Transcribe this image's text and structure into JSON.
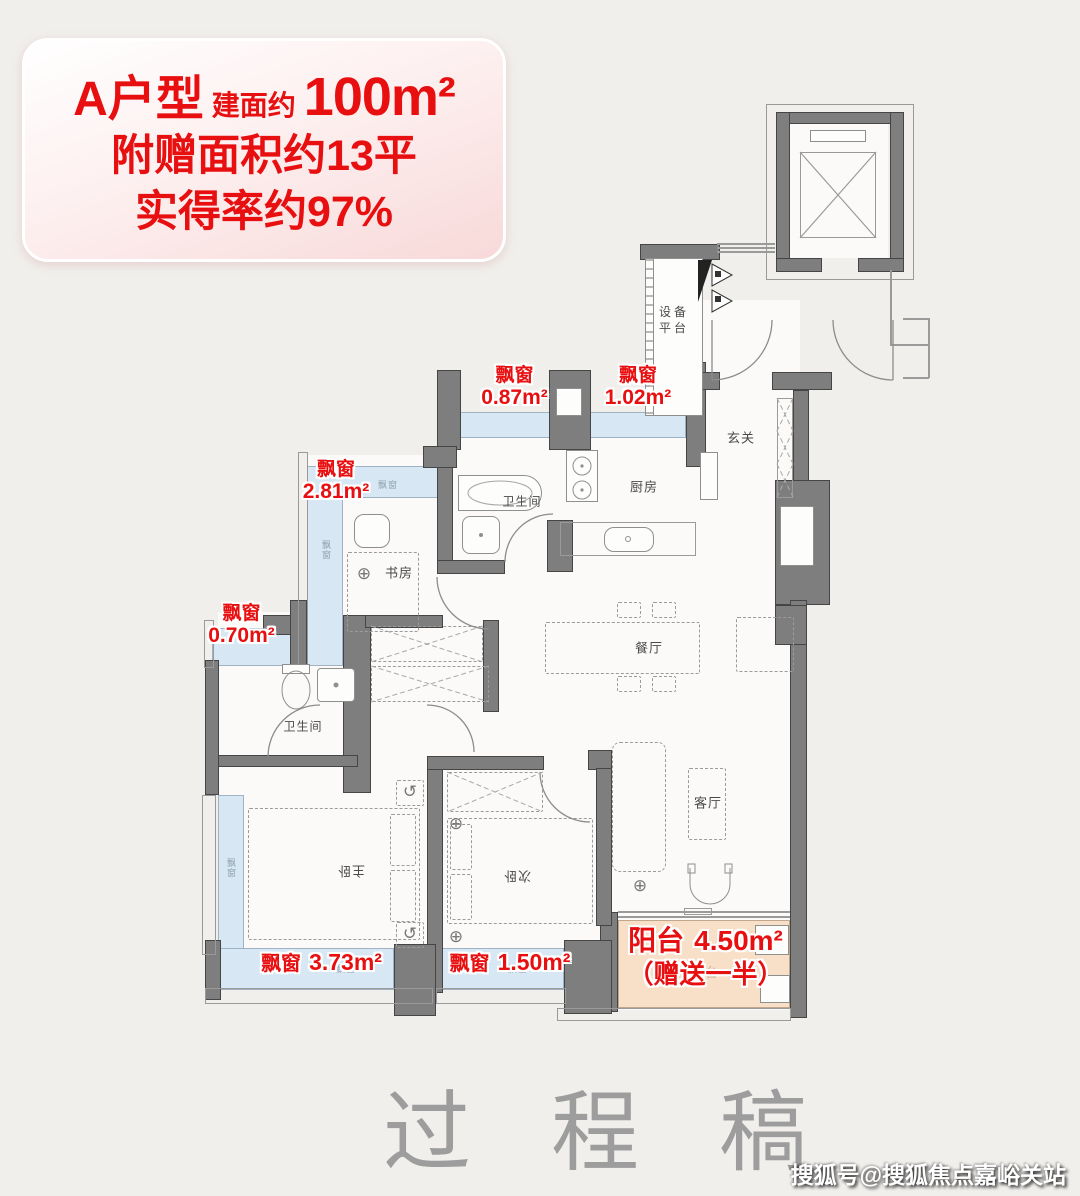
{
  "info_box": {
    "type_label": "A户型",
    "area_prefix": "建面约",
    "area_value": "100m²",
    "bonus_line": "附赠面积约13平",
    "rate_line": "实得率约97%"
  },
  "rooms": {
    "equipment_platform": "设备平台",
    "entry": "玄关",
    "kitchen": "厨房",
    "bathroom_upper": "卫生间",
    "study": "书房",
    "bathroom_lower": "卫生间",
    "dining": "餐厅",
    "living": "客厅",
    "master_bedroom": "主卧",
    "second_bedroom": "次卧"
  },
  "bay_tag": "飘窗",
  "bay_labels": {
    "b087": {
      "name": "飘窗",
      "area": "0.87m²"
    },
    "b102": {
      "name": "飘窗",
      "area": "1.02m²"
    },
    "b281": {
      "name": "飘窗",
      "area": "2.81m²"
    },
    "b070": {
      "name": "飘窗",
      "area": "0.70m²"
    },
    "b373": {
      "name": "飘窗",
      "area": "3.73m²"
    },
    "b150": {
      "name": "飘窗",
      "area": "1.50m²"
    }
  },
  "balcony_label": {
    "name": "阳台",
    "area": "4.50m²",
    "note": "（赠送一半）",
    "bg_text": "阳台"
  },
  "watermark": "过程稿",
  "credit": "搜狐号@搜狐焦点嘉峪关站",
  "icons": {
    "compass": "⊕",
    "rotate": "↺"
  },
  "colors": {
    "accent_red": "#e80f10",
    "bay_fill": "#d7e8f4",
    "balcony_fill": "#f8dfc8",
    "wall_gray": "#7e7e7e"
  }
}
